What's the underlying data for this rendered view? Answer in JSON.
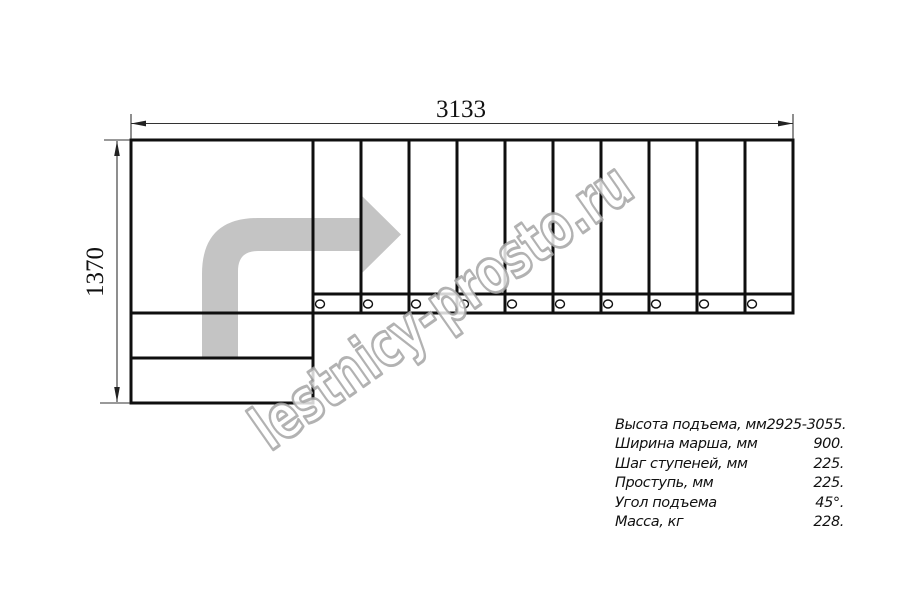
{
  "dimensions": {
    "top_width_mm": "3133",
    "left_height_mm": "1370"
  },
  "watermark": "lestnicy-prosto.ru",
  "specs": [
    {
      "label": "Высота подъема, мм",
      "value": "2925-3055."
    },
    {
      "label": "Ширина марша, мм",
      "value": "900."
    },
    {
      "label": "Шаг ступеней, мм",
      "value": "225."
    },
    {
      "label": "Проступь, мм",
      "value": "225."
    },
    {
      "label": "Угол подъема",
      "value": "45°."
    },
    {
      "label": "Масса, кг",
      "value": "228."
    }
  ],
  "stairs": {
    "straight_flight_steps": 10,
    "bottom_steps": 2,
    "fastener_circles": 10,
    "turn_direction": "up-then-right"
  },
  "colors": {
    "line": "#0f0f0f",
    "dimension_line": "#333333",
    "arrow_fill": "#c4c4c4",
    "watermark_stroke": "#a5a5a5",
    "background": "#ffffff"
  }
}
